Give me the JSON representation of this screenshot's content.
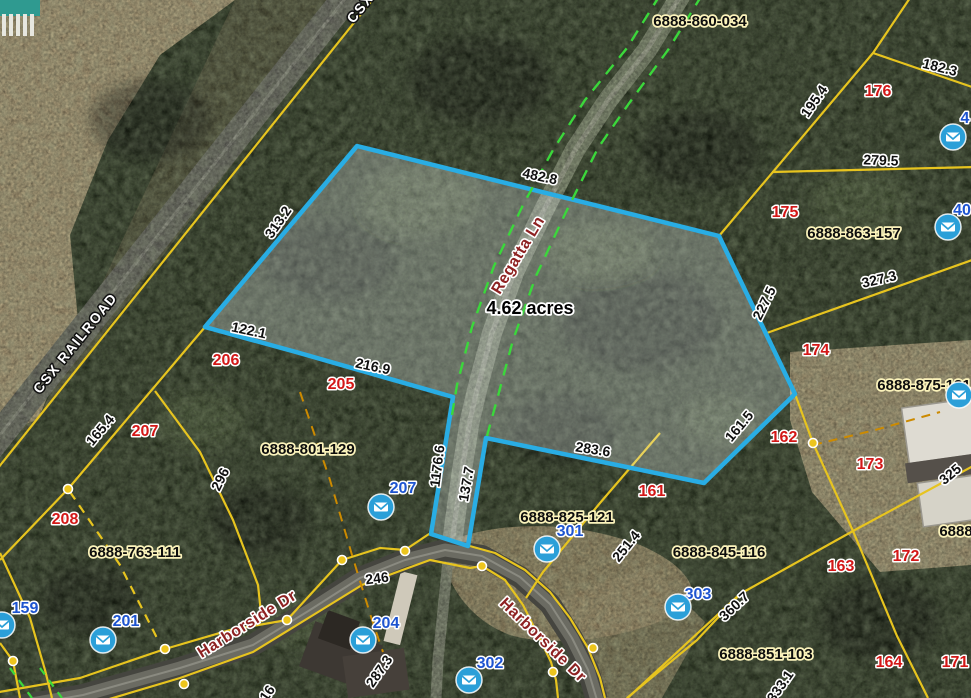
{
  "map": {
    "highlighted_parcel": {
      "area_label": "4.62 acres",
      "area_label_pos": {
        "x": 530,
        "y": 309
      },
      "outline_color": "#29ADE4",
      "boundary_dimensions": [
        "482.8",
        "313.2",
        "122.1",
        "216.9",
        "1176.6",
        "137.7",
        "283.6",
        "161.5",
        "227.5"
      ]
    },
    "labels": {
      "dimensions": [
        {
          "text": "482.8",
          "x": 540,
          "y": 176,
          "rot": 12
        },
        {
          "text": "313.2",
          "x": 278,
          "y": 222,
          "rot": -55
        },
        {
          "text": "122.1",
          "x": 249,
          "y": 330,
          "rot": 12
        },
        {
          "text": "216.9",
          "x": 373,
          "y": 366,
          "rot": 12
        },
        {
          "text": "1176.6",
          "x": 437,
          "y": 466,
          "rot": -83
        },
        {
          "text": "137.7",
          "x": 466,
          "y": 484,
          "rot": -80
        },
        {
          "text": "283.6",
          "x": 593,
          "y": 449,
          "rot": 9
        },
        {
          "text": "161.5",
          "x": 739,
          "y": 426,
          "rot": -50
        },
        {
          "text": "227.5",
          "x": 764,
          "y": 303,
          "rot": -64
        },
        {
          "text": "195.4",
          "x": 814,
          "y": 101,
          "rot": -55
        },
        {
          "text": "182.3",
          "x": 940,
          "y": 67,
          "rot": 14
        },
        {
          "text": "279.5",
          "x": 881,
          "y": 160,
          "rot": 2
        },
        {
          "text": "327.3",
          "x": 879,
          "y": 279,
          "rot": -13
        },
        {
          "text": "325",
          "x": 950,
          "y": 474,
          "rot": -40
        },
        {
          "text": "165.4",
          "x": 100,
          "y": 430,
          "rot": -50
        },
        {
          "text": "296",
          "x": 220,
          "y": 479,
          "rot": -64
        },
        {
          "text": "251.4",
          "x": 626,
          "y": 546,
          "rot": -51
        },
        {
          "text": "360.7",
          "x": 734,
          "y": 606,
          "rot": -43
        },
        {
          "text": "246",
          "x": 377,
          "y": 578,
          "rot": -7
        },
        {
          "text": "287.3",
          "x": 379,
          "y": 671,
          "rot": -55
        },
        {
          "text": "333.1",
          "x": 780,
          "y": 686,
          "rot": -55
        },
        {
          "text": "16",
          "x": 267,
          "y": 693,
          "rot": -55
        }
      ],
      "parcel_ids": [
        {
          "text": "6888-860-034",
          "x": 700,
          "y": 21,
          "rot": 0
        },
        {
          "text": "6888-863-157",
          "x": 854,
          "y": 233,
          "rot": 0
        },
        {
          "text": "6888-875-131",
          "x": 924,
          "y": 385,
          "rot": 0
        },
        {
          "text": "6888-801-129",
          "x": 308,
          "y": 449,
          "rot": 0
        },
        {
          "text": "6888-825-121",
          "x": 567,
          "y": 517,
          "rot": 0
        },
        {
          "text": "6888-845-116",
          "x": 719,
          "y": 552,
          "rot": 0
        },
        {
          "text": "6888-763-111",
          "x": 135,
          "y": 552,
          "rot": 0
        },
        {
          "text": "6888-851-103",
          "x": 766,
          "y": 654,
          "rot": 0
        },
        {
          "text": "6888",
          "x": 956,
          "y": 531,
          "rot": 0
        }
      ],
      "lot_numbers_red": [
        {
          "text": "176",
          "x": 878,
          "y": 91
        },
        {
          "text": "175",
          "x": 785,
          "y": 212
        },
        {
          "text": "174",
          "x": 816,
          "y": 350
        },
        {
          "text": "206",
          "x": 226,
          "y": 360
        },
        {
          "text": "205",
          "x": 341,
          "y": 384
        },
        {
          "text": "207",
          "x": 145,
          "y": 431
        },
        {
          "text": "208",
          "x": 65,
          "y": 519
        },
        {
          "text": "162",
          "x": 784,
          "y": 437
        },
        {
          "text": "161",
          "x": 652,
          "y": 491
        },
        {
          "text": "173",
          "x": 870,
          "y": 464
        },
        {
          "text": "163",
          "x": 841,
          "y": 566
        },
        {
          "text": "172",
          "x": 906,
          "y": 556
        },
        {
          "text": "164",
          "x": 889,
          "y": 662
        },
        {
          "text": "171",
          "x": 955,
          "y": 662
        }
      ],
      "lot_numbers_blue": [
        {
          "text": "207",
          "x": 403,
          "y": 488
        },
        {
          "text": "301",
          "x": 570,
          "y": 531
        },
        {
          "text": "303",
          "x": 698,
          "y": 594
        },
        {
          "text": "302",
          "x": 490,
          "y": 663
        },
        {
          "text": "204",
          "x": 386,
          "y": 623
        },
        {
          "text": "201",
          "x": 126,
          "y": 621
        },
        {
          "text": "159",
          "x": 25,
          "y": 608
        },
        {
          "text": "4",
          "x": 965,
          "y": 118
        },
        {
          "text": "40",
          "x": 962,
          "y": 210
        }
      ],
      "road_names": [
        {
          "text": "Regatta Ln",
          "x": 518,
          "y": 255,
          "rot": -59,
          "style": "road"
        },
        {
          "text": "Harborside Dr",
          "x": 247,
          "y": 624,
          "rot": -32,
          "style": "road"
        },
        {
          "text": "Harborside Dr",
          "x": 543,
          "y": 640,
          "rot": 44,
          "style": "road"
        },
        {
          "text": "CSX RAILROAD",
          "x": 75,
          "y": 343,
          "rot": -51,
          "style": "rail"
        },
        {
          "text": "CSX",
          "x": 360,
          "y": 8,
          "rot": -51,
          "style": "rail"
        }
      ]
    },
    "icons": {
      "mail_icon_positions": [
        [
          953,
          137
        ],
        [
          948,
          227
        ],
        [
          959,
          395
        ],
        [
          381,
          507
        ],
        [
          547,
          549
        ],
        [
          678,
          607
        ],
        [
          363,
          640
        ],
        [
          469,
          680
        ],
        [
          103,
          640
        ],
        [
          2,
          625
        ]
      ]
    },
    "boundary_vertex_dots": [
      [
        13,
        661
      ],
      [
        68,
        489
      ],
      [
        165,
        649
      ],
      [
        287,
        620
      ],
      [
        342,
        560
      ],
      [
        405,
        551
      ],
      [
        482,
        566
      ],
      [
        553,
        672
      ],
      [
        593,
        648
      ],
      [
        813,
        443
      ],
      [
        184,
        684
      ]
    ],
    "colors": {
      "parcel_line": "#E7C41F",
      "highlight_outline": "#29ADE4",
      "right_of_way_dashed": "#3BD83B",
      "mail_icon": "#2B9FD8",
      "red_lot": "#D31717",
      "blue_lot": "#1D54D0"
    }
  }
}
